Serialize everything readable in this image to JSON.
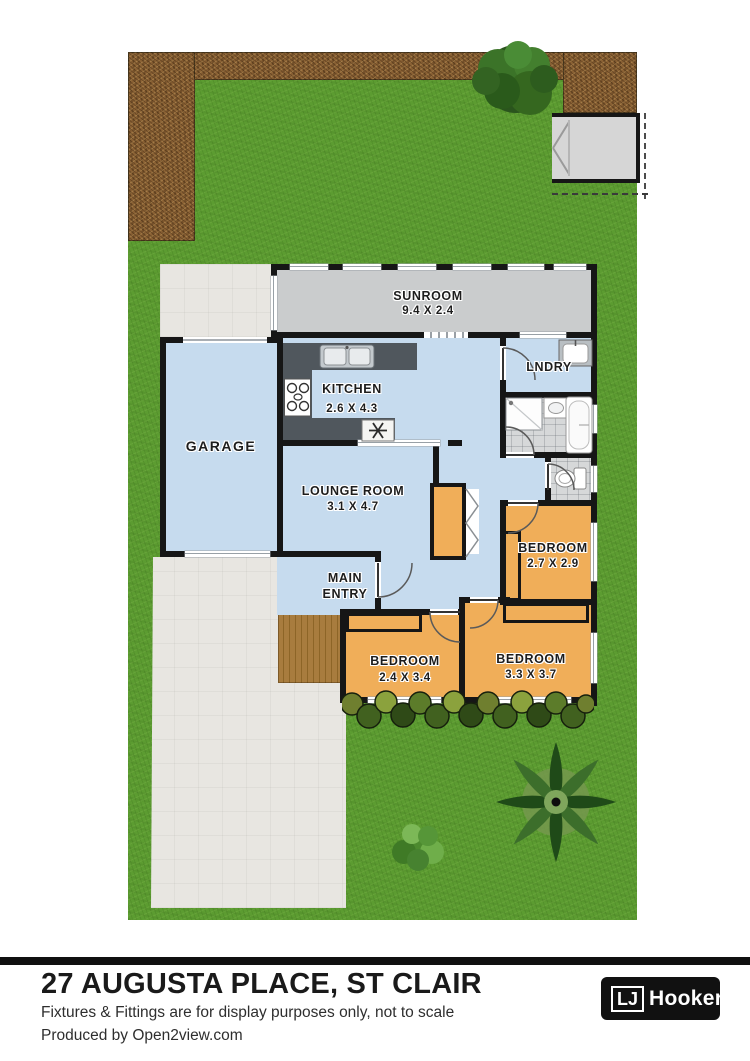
{
  "footer": {
    "title": "27 AUGUSTA PLACE, ST CLAIR",
    "disclaimer": "Fixtures & Fittings are for display purposes only, not to scale",
    "credit": "Produced by Open2view.com",
    "logo": {
      "prefix": "LJ",
      "name": "Hooker"
    }
  },
  "rooms": {
    "sunroom": {
      "name": "SUNROOM",
      "dims": "9.4 X 2.4"
    },
    "kitchen": {
      "name": "KITCHEN",
      "dims": "2.6 X 4.3"
    },
    "laundry": {
      "name": "LNDRY"
    },
    "garage": {
      "name": "GARAGE"
    },
    "lounge": {
      "name": "LOUNGE ROOM",
      "dims": "3.1 X 4.7"
    },
    "main_entry": {
      "line1": "MAIN",
      "line2": "ENTRY"
    },
    "bedroom_right": {
      "name": "BEDROOM",
      "dims": "2.7 X 2.9"
    },
    "bedroom_left": {
      "name": "BEDROOM",
      "dims": "2.4 X 3.4"
    },
    "bedroom_bottom": {
      "name": "BEDROOM",
      "dims": "3.3 X 3.7"
    }
  },
  "colors": {
    "lawn": "#5c9c31",
    "garden_bed": "#8a6134",
    "room_floor_blue": "#c6dbee",
    "bedroom_orange": "#f0ae59",
    "sunroom_gray": "#cacccd",
    "tile": "#d6d8d9",
    "deck_wood": "#a87c3e",
    "paving": "#e8e6e1",
    "wall": "#161616",
    "logo_black": "#111111",
    "logo_yellow": "#ffc20e",
    "logo_red": "#cf1820"
  }
}
